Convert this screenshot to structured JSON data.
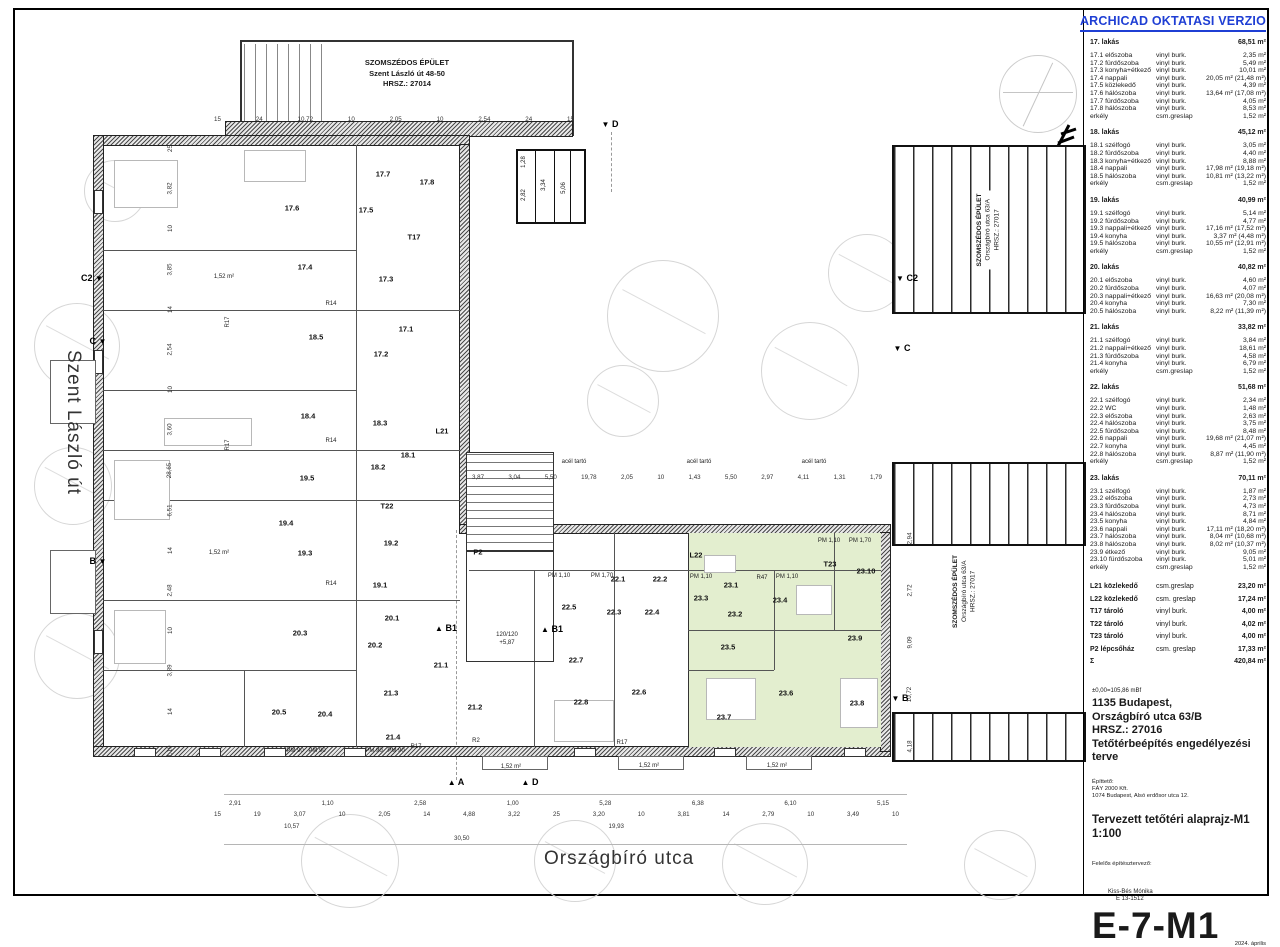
{
  "banner": "ARCHICAD OKTATASI VERZIO",
  "streets": {
    "left": "Szent László út",
    "bottom": "Országbíró utca"
  },
  "neighbors": {
    "top": [
      "SZOMSZÉDOS ÉPÜLET",
      "Szent László út 48-50",
      "HRSZ.: 27014"
    ],
    "right_upper": [
      "SZOMSZÉDOS ÉPÜLET",
      "Országbíró utca 63/A",
      "HRSZ.: 27017"
    ],
    "right_lower": [
      "SZOMSZÉDOS ÉPÜLET",
      "Országbíró utca 63/A",
      "HRSZ.: 27017"
    ]
  },
  "plan": {
    "room_labels": [
      {
        "t": "17.1",
        "x": 392,
        "y": 319
      },
      {
        "t": "17.2",
        "x": 367,
        "y": 344
      },
      {
        "t": "17.3",
        "x": 372,
        "y": 269
      },
      {
        "t": "17.4",
        "x": 291,
        "y": 257
      },
      {
        "t": "17.5",
        "x": 352,
        "y": 200
      },
      {
        "t": "17.6",
        "x": 278,
        "y": 198
      },
      {
        "t": "17.7",
        "x": 369,
        "y": 164
      },
      {
        "t": "17.8",
        "x": 413,
        "y": 172
      },
      {
        "t": "18.1",
        "x": 394,
        "y": 445
      },
      {
        "t": "18.2",
        "x": 364,
        "y": 457
      },
      {
        "t": "18.3",
        "x": 366,
        "y": 413
      },
      {
        "t": "18.4",
        "x": 294,
        "y": 406
      },
      {
        "t": "18.5",
        "x": 302,
        "y": 327
      },
      {
        "t": "19.1",
        "x": 366,
        "y": 575
      },
      {
        "t": "19.2",
        "x": 377,
        "y": 533
      },
      {
        "t": "19.3",
        "x": 291,
        "y": 543
      },
      {
        "t": "19.4",
        "x": 272,
        "y": 513
      },
      {
        "t": "19.5",
        "x": 293,
        "y": 468
      },
      {
        "t": "20.1",
        "x": 378,
        "y": 608
      },
      {
        "t": "20.2",
        "x": 361,
        "y": 635
      },
      {
        "t": "20.3",
        "x": 286,
        "y": 623
      },
      {
        "t": "20.4",
        "x": 311,
        "y": 704
      },
      {
        "t": "20.5",
        "x": 265,
        "y": 702
      },
      {
        "t": "21.1",
        "x": 427,
        "y": 655
      },
      {
        "t": "21.2",
        "x": 461,
        "y": 697
      },
      {
        "t": "21.3",
        "x": 377,
        "y": 683
      },
      {
        "t": "21.4",
        "x": 379,
        "y": 727
      },
      {
        "t": "22.1",
        "x": 604,
        "y": 569
      },
      {
        "t": "22.2",
        "x": 646,
        "y": 569
      },
      {
        "t": "22.3",
        "x": 600,
        "y": 602
      },
      {
        "t": "22.4",
        "x": 638,
        "y": 602
      },
      {
        "t": "22.5",
        "x": 555,
        "y": 597
      },
      {
        "t": "22.6",
        "x": 625,
        "y": 682
      },
      {
        "t": "22.7",
        "x": 562,
        "y": 650
      },
      {
        "t": "22.8",
        "x": 567,
        "y": 692
      },
      {
        "t": "23.1",
        "x": 717,
        "y": 575
      },
      {
        "t": "23.2",
        "x": 721,
        "y": 604
      },
      {
        "t": "23.3",
        "x": 687,
        "y": 588
      },
      {
        "t": "23.4",
        "x": 766,
        "y": 590
      },
      {
        "t": "23.5",
        "x": 714,
        "y": 637
      },
      {
        "t": "23.6",
        "x": 772,
        "y": 683
      },
      {
        "t": "23.7",
        "x": 710,
        "y": 707
      },
      {
        "t": "23.8",
        "x": 843,
        "y": 693
      },
      {
        "t": "23.9",
        "x": 841,
        "y": 628
      },
      {
        "t": "23.10",
        "x": 852,
        "y": 561
      },
      {
        "t": "T17",
        "x": 400,
        "y": 227
      },
      {
        "t": "T22",
        "x": 373,
        "y": 496
      },
      {
        "t": "T23",
        "x": 816,
        "y": 554
      },
      {
        "t": "L21",
        "x": 428,
        "y": 421
      },
      {
        "t": "L22",
        "x": 682,
        "y": 545
      },
      {
        "t": "P2",
        "x": 464,
        "y": 542
      }
    ],
    "small_labels": [
      {
        "t": "R14",
        "x": 317,
        "y": 294
      },
      {
        "t": "R14",
        "x": 317,
        "y": 431
      },
      {
        "t": "R14",
        "x": 317,
        "y": 574
      },
      {
        "t": "R17",
        "x": 214,
        "y": 312,
        "r": 1
      },
      {
        "t": "R17",
        "x": 214,
        "y": 435,
        "r": 1
      },
      {
        "t": "R17",
        "x": 402,
        "y": 737
      },
      {
        "t": "R17",
        "x": 608,
        "y": 733
      },
      {
        "t": "R2",
        "x": 462,
        "y": 731
      },
      {
        "t": "R47",
        "x": 748,
        "y": 568
      },
      {
        "t": "PM 90",
        "x": 281,
        "y": 741
      },
      {
        "t": "PM 90",
        "x": 303,
        "y": 741
      },
      {
        "t": "PM 90",
        "x": 360,
        "y": 741
      },
      {
        "t": "PM 90",
        "x": 382,
        "y": 741
      },
      {
        "t": "PM 1,10",
        "x": 545,
        "y": 566
      },
      {
        "t": "PM 1,70",
        "x": 588,
        "y": 566
      },
      {
        "t": "PM 1,10",
        "x": 687,
        "y": 567
      },
      {
        "t": "PM 1,10",
        "x": 773,
        "y": 567
      },
      {
        "t": "PM 1,10",
        "x": 815,
        "y": 531
      },
      {
        "t": "PM 1,70",
        "x": 846,
        "y": 531
      },
      {
        "t": "1,52 m²",
        "x": 210,
        "y": 267
      },
      {
        "t": "1,52 m²",
        "x": 205,
        "y": 543
      },
      {
        "t": "1,52 m²",
        "x": 497,
        "y": 757
      },
      {
        "t": "1,52 m²",
        "x": 635,
        "y": 756
      },
      {
        "t": "1,52 m²",
        "x": 763,
        "y": 756
      },
      {
        "t": "120/120",
        "x": 493,
        "y": 625
      },
      {
        "t": "+5,87",
        "x": 493,
        "y": 633
      },
      {
        "t": "acél tartó",
        "x": 560,
        "y": 452
      },
      {
        "t": "acél tartó",
        "x": 685,
        "y": 452
      },
      {
        "t": "acél tartó",
        "x": 800,
        "y": 452
      },
      {
        "t": "2,82",
        "x": 510,
        "y": 185,
        "r": 1
      },
      {
        "t": "1,28",
        "x": 510,
        "y": 152,
        "r": 1
      },
      {
        "t": "3,34",
        "x": 530,
        "y": 175,
        "r": 1
      },
      {
        "t": "5,06",
        "x": 550,
        "y": 178,
        "r": 1
      }
    ],
    "section_markers": [
      {
        "t": "C2",
        "x": 78,
        "y": 268,
        "tri": "▼",
        "order": "lt"
      },
      {
        "t": "C",
        "x": 84,
        "y": 331,
        "tri": "▼",
        "order": "lt"
      },
      {
        "t": "B",
        "x": 84,
        "y": 551,
        "tri": "▼",
        "order": "lt"
      },
      {
        "t": "C2",
        "x": 893,
        "y": 268,
        "tri": "▼",
        "order": "tl"
      },
      {
        "t": "C",
        "x": 888,
        "y": 338,
        "tri": "▼",
        "order": "tl"
      },
      {
        "t": "B",
        "x": 886,
        "y": 688,
        "tri": "▼",
        "order": "tl"
      },
      {
        "t": "D",
        "x": 596,
        "y": 114,
        "tri": "▼",
        "order": "tl"
      },
      {
        "t": "A",
        "x": 442,
        "y": 772,
        "tri": "▲",
        "order": "tl"
      },
      {
        "t": "D",
        "x": 516,
        "y": 772,
        "tri": "▲",
        "order": "tl"
      },
      {
        "t": "B1",
        "x": 432,
        "y": 618,
        "tri": "▲",
        "order": "tl"
      },
      {
        "t": "B1",
        "x": 538,
        "y": 619,
        "tri": "▲",
        "order": "tl"
      }
    ],
    "dims": {
      "top_row": [
        "15",
        "24",
        "10,72",
        "10",
        "2,05",
        "10",
        "2,54",
        "24",
        "15"
      ],
      "mid_row": [
        "3,87",
        "3,04",
        "5,50",
        "19,78",
        "2,05",
        "10",
        "1,43",
        "5,50",
        "2,97",
        "4,11",
        "1,31",
        "1,79"
      ],
      "bottom_row_1": [
        "2,91",
        "1,10",
        "2,58",
        "1,00",
        "5,28",
        "6,38",
        "6,10",
        "5,15"
      ],
      "bottom_row_2": [
        "15",
        "19",
        "3,07",
        "10",
        "2,05",
        "14",
        "4,88",
        "3,22",
        "25",
        "3,20",
        "10",
        "3,81",
        "14",
        "2,79",
        "10",
        "3,49",
        "10"
      ],
      "bottom_row_3": [
        "10,57",
        "19,93"
      ],
      "bottom_row_4": [
        "30,50"
      ],
      "left_col": [
        "25",
        "3,82",
        "10",
        "3,85",
        "14",
        "2,54",
        "10",
        "3,60",
        "28,65",
        "6,51",
        "14",
        "2,48",
        "10",
        "3,89",
        "14",
        "1,19"
      ],
      "right_col": [
        "2,94",
        "2,72",
        "9,09",
        "10,72",
        "4,18"
      ]
    }
  },
  "schedule": {
    "apartments": [
      {
        "name": "17. lakás",
        "total": "68,51 m²",
        "rows": [
          [
            "17.1 előszoba",
            "vinyl burk.",
            "2,35 m²"
          ],
          [
            "17.2 fürdőszoba",
            "vinyl burk.",
            "5,49 m²"
          ],
          [
            "17.3 konyha+étkező",
            "vinyl burk.",
            "10,01 m²"
          ],
          [
            "17.4 nappali",
            "vinyl burk.",
            "20,05 m² (21,48 m²)"
          ],
          [
            "17.5 közlekedő",
            "vinyl burk.",
            "4,39 m²"
          ],
          [
            "17.6 hálószoba",
            "vinyl burk.",
            "13,64 m² (17,08 m²)"
          ],
          [
            "17.7 fürdőszoba",
            "vinyl burk.",
            "4,05 m²"
          ],
          [
            "17.8 hálószoba",
            "vinyl burk.",
            "8,53 m²"
          ],
          [
            "erkély",
            "csm.greslap",
            "1,52 m²"
          ]
        ]
      },
      {
        "name": "18. lakás",
        "total": "45,12 m²",
        "rows": [
          [
            "18.1 szélfogó",
            "vinyl burk.",
            "3,05 m²"
          ],
          [
            "18.2 fürdőszoba",
            "vinyl burk.",
            "4,40 m²"
          ],
          [
            "18.3 konyha+étkező",
            "vinyl burk.",
            "8,88 m²"
          ],
          [
            "18.4 nappali",
            "vinyl burk.",
            "17,98 m² (19,18 m²)"
          ],
          [
            "18.5 hálószoba",
            "vinyl burk.",
            "10,81 m² (13,22 m²)"
          ],
          [
            "erkély",
            "csm.greslap",
            "1,52 m²"
          ]
        ]
      },
      {
        "name": "19. lakás",
        "total": "40,99 m²",
        "rows": [
          [
            "19.1 szélfogó",
            "vinyl burk.",
            "5,14 m²"
          ],
          [
            "19.2 fürdőszoba",
            "vinyl burk.",
            "4,77 m²"
          ],
          [
            "19.3 nappali+étkező",
            "vinyl burk.",
            "17,16 m² (17,52 m²)"
          ],
          [
            "19.4 konyha",
            "vinyl burk.",
            "3,37 m² (4,48 m²)"
          ],
          [
            "19.5 hálószoba",
            "vinyl burk.",
            "10,55 m² (12,91 m²)"
          ],
          [
            "erkély",
            "csm.greslap",
            "1,52 m²"
          ]
        ]
      },
      {
        "name": "20. lakás",
        "total": "40,82 m²",
        "rows": [
          [
            "20.1 előszoba",
            "vinyl burk.",
            "4,60 m²"
          ],
          [
            "20.2 fürdőszoba",
            "vinyl burk.",
            "4,07 m²"
          ],
          [
            "20.3 nappali+étkező",
            "vinyl burk.",
            "16,63 m² (20,08 m²)"
          ],
          [
            "20.4 konyha",
            "vinyl burk.",
            "7,30 m²"
          ],
          [
            "20.5 hálószoba",
            "vinyl burk.",
            "8,22 m² (11,39 m²)"
          ]
        ]
      },
      {
        "name": "21. lakás",
        "total": "33,82 m²",
        "rows": [
          [
            "21.1 szélfogó",
            "vinyl burk.",
            "3,84 m²"
          ],
          [
            "21.2 nappali+étkező",
            "vinyl burk.",
            "18,61 m²"
          ],
          [
            "21.3 fürdőszoba",
            "vinyl burk.",
            "4,58 m²"
          ],
          [
            "21.4 konyha",
            "vinyl burk.",
            "6,79 m²"
          ],
          [
            "erkély",
            "csm.greslap",
            "1,52 m²"
          ]
        ]
      },
      {
        "name": "22. lakás",
        "total": "51,68 m²",
        "rows": [
          [
            "22.1 szélfogó",
            "vinyl burk.",
            "2,34 m²"
          ],
          [
            "22.2 WC",
            "vinyl burk.",
            "1,48 m²"
          ],
          [
            "22.3 előszoba",
            "vinyl burk.",
            "2,63 m²"
          ],
          [
            "22.4 hálószoba",
            "vinyl burk.",
            "3,75 m²"
          ],
          [
            "22.5 fürdőszoba",
            "vinyl burk.",
            "8,48 m²"
          ],
          [
            "22.6 nappali",
            "vinyl burk.",
            "19,68 m² (21,07 m²)"
          ],
          [
            "22.7 konyha",
            "vinyl burk.",
            "4,45 m²"
          ],
          [
            "22.8 hálószoba",
            "vinyl burk.",
            "8,87 m² (11,90 m²)"
          ],
          [
            "erkély",
            "csm.greslap",
            "1,52 m²"
          ]
        ]
      },
      {
        "name": "23. lakás",
        "total": "70,11 m²",
        "rows": [
          [
            "23.1 szélfogó",
            "vinyl burk.",
            "1,87 m²"
          ],
          [
            "23.2 előszoba",
            "vinyl burk.",
            "2,73 m²"
          ],
          [
            "23.3 fürdőszoba",
            "vinyl burk.",
            "4,73 m²"
          ],
          [
            "23.4 hálószoba",
            "vinyl burk.",
            "8,71 m²"
          ],
          [
            "23.5 konyha",
            "vinyl burk.",
            "4,84 m²"
          ],
          [
            "23.6 nappali",
            "vinyl burk.",
            "17,11 m² (18,20 m²)"
          ],
          [
            "23.7 hálószoba",
            "vinyl burk.",
            "8,04 m² (10,68 m²)"
          ],
          [
            "23.8 hálószoba",
            "vinyl burk.",
            "8,02 m² (10,37 m²)"
          ],
          [
            "23.9 étkező",
            "vinyl burk.",
            "9,05 m²"
          ],
          [
            "23.10 fürdőszoba",
            "vinyl burk.",
            "5,01 m²"
          ],
          [
            "erkély",
            "csm.greslap",
            "1,52 m²"
          ]
        ]
      }
    ],
    "extras": [
      [
        "L21 közlekedő",
        "csm.greslap",
        "23,20 m²"
      ],
      [
        "L22 közlekedő",
        "csm. greslap",
        "17,24 m²"
      ],
      [
        "T17 tároló",
        "vinyl burk.",
        "4,00 m²"
      ],
      [
        "T22 tároló",
        "vinyl burk.",
        "4,02 m²"
      ],
      [
        "T23 tároló",
        "vinyl burk.",
        "4,00 m²"
      ],
      [
        "P2 lépcsőház",
        "csm. greslap",
        "17,33 m²"
      ],
      [
        "Σ",
        "",
        "420,84 m²"
      ]
    ]
  },
  "titleblock": {
    "elevation": "±0,00=105,86 mBf",
    "address1": "1135 Budapest,",
    "address2": "Országbíró utca 63/B",
    "address3": "HRSZ.: 27016",
    "project": "Tetőtérbeépítés engedélyezési terve",
    "client_label": "Építtető:",
    "client_name": "FÁY 2000 Kft.",
    "client_address": "1074 Budapest, Alsó erdősor utca 12.",
    "drawing_title": "Tervezett tetőtéri alaprajz-M1",
    "scale": "1:100",
    "designer_label": "Felelős építésztervező:",
    "designer_name": "Kiss-Bés Mónika",
    "designer_reg": "É 13-1512",
    "drawing_number": "E-7-M1",
    "date": "2024. április"
  },
  "colors": {
    "banner_blue": "#1f3fd4",
    "apartment_green": "#e3eecf"
  }
}
